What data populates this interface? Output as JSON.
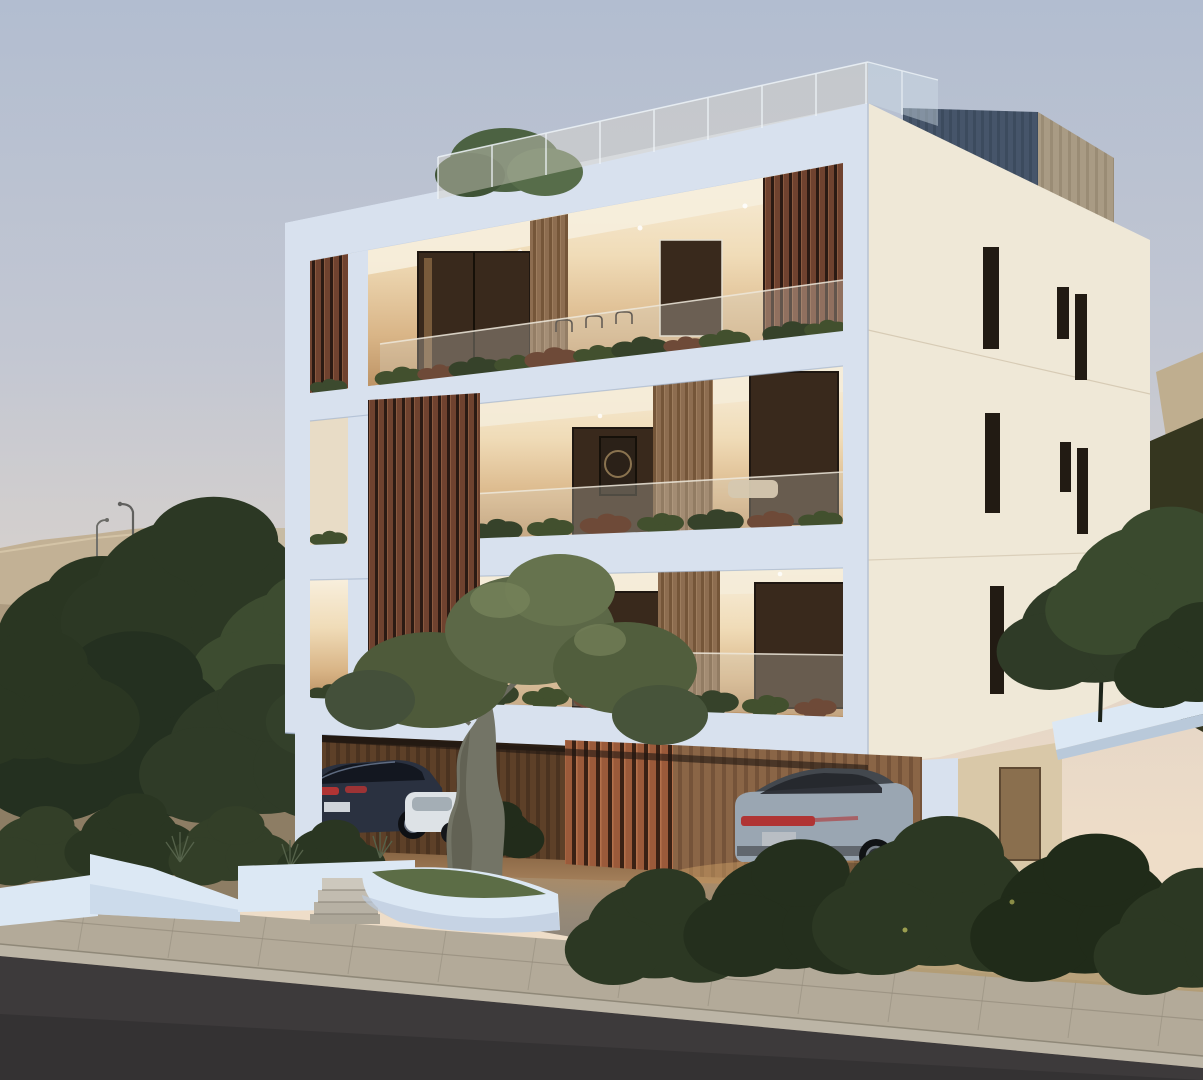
{
  "scene": {
    "type": "3d-architectural-exterior-render",
    "subject": "modern-three-storey-apartment-building",
    "time_of_day": "dusk",
    "floors_visible": 3,
    "has_roof_terrace": true,
    "car_count": 3,
    "palette": {
      "sky_top": "#b2bdd0",
      "sky_horizon": "#eeddc8",
      "hillside_sand": "#c2b195",
      "hill_shadow": "#a6947a",
      "ground_dark": "#8d7d64",
      "tree_dark": "#2c3824",
      "tree_mid": "#3d4c30",
      "olive_foliage": "#5c6847",
      "olive_trunk": "#737466",
      "facade_front": "#c9d5e6",
      "facade_front_bright": "#d8e1ee",
      "facade_side": "#efe8d7",
      "roof_box_dark": "#46556a",
      "roof_box_tan": "#a99b84",
      "wood_slat": "#6f422f",
      "wood_pillar": "#8d6d50",
      "carport_wood": "#5d4028",
      "interior_warm": "#f0dcb8",
      "window_glass": "#39291c",
      "balustrade_glass": "#d8d3c8",
      "planter_white": "#dce8f4",
      "plant_green": "#42502e",
      "plant_red": "#6e4a38",
      "lawn_green": "#4e5f33",
      "car_sedan_dark": "#2a3140",
      "car_white": "#dde2e6",
      "car_suv_silver": "#9aa6b2",
      "taillight_red": "#b03434",
      "driveway": "#938b80",
      "sidewalk": "#b3aa99",
      "curb": "#bcb5a6",
      "road": "#3d3a3b",
      "dry_grass": "#b29b72"
    },
    "objects": [
      "apartment-building",
      "roof-terrace-glass-balustrade",
      "rooftop-stair-box",
      "wooden-louvre-screens",
      "balcony-glass-balustrades",
      "balcony-planters",
      "carport",
      "sedan-car-dark",
      "hatchback-car-white",
      "suv-car-silver",
      "olive-tree",
      "white-landscape-planters",
      "garden-steps",
      "hillside",
      "street-lamps",
      "background-trees",
      "foreground-bushes",
      "sidewalk",
      "road"
    ]
  }
}
